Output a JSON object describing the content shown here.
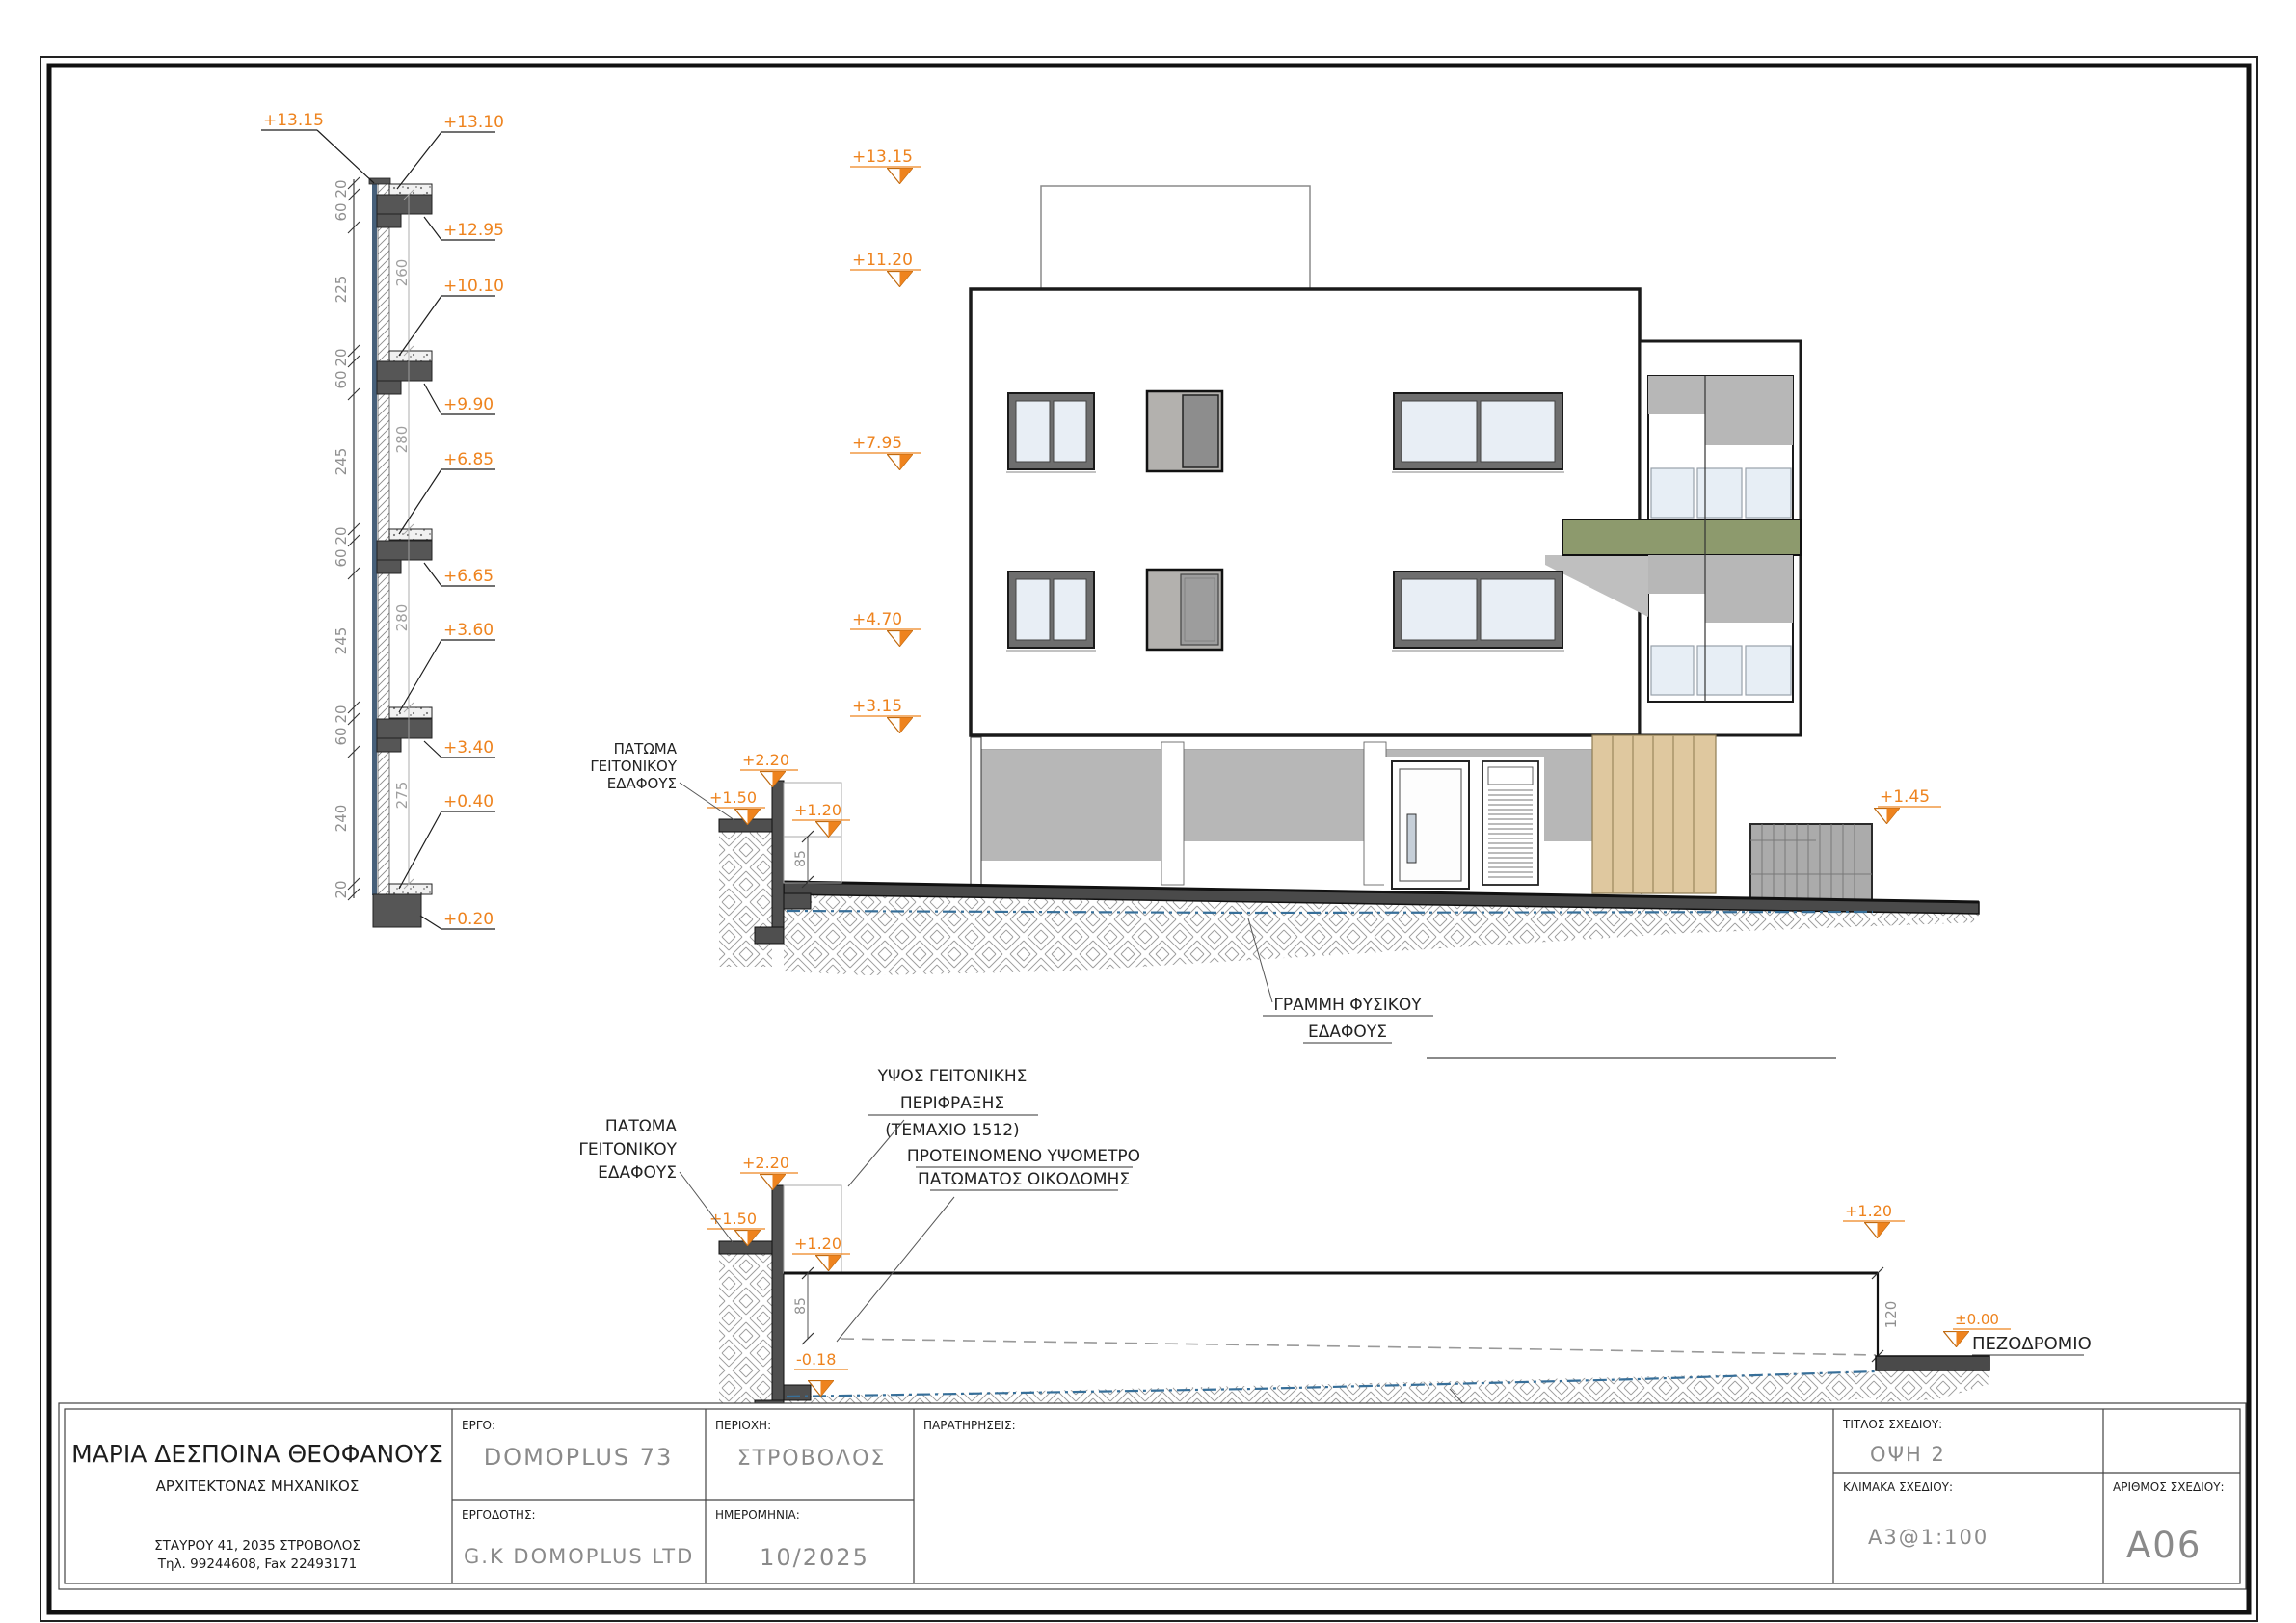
{
  "left_detail": {
    "top_callout": "+13.15",
    "right_callouts": [
      "+13.10",
      "+12.95",
      "+10.10",
      "+9.90",
      "+6.85",
      "+6.65",
      "+3.60",
      "+3.40",
      "+0.40",
      "+0.20"
    ],
    "outer_dims": [
      "20",
      "60",
      "225",
      "20",
      "60",
      "245",
      "20",
      "60",
      "245",
      "20",
      "60",
      "240",
      "20"
    ],
    "inner_dims": [
      "260",
      "280",
      "280",
      "275"
    ]
  },
  "elevation": {
    "markers": [
      "+13.15",
      "+11.20",
      "+7.95",
      "+4.70",
      "+3.15"
    ],
    "fence_marker": "+1.45"
  },
  "section1": {
    "patoma": [
      "ΠΑΤΩΜΑ",
      "ΓΕΙΤΟΝΙΚΟΥ",
      "ΕΔΑΦΟΥΣ"
    ],
    "m220": "+2.20",
    "m150": "+1.50",
    "m120": "+1.20",
    "d85": "85",
    "grammi": [
      "ΓΡΑΜΜΗ ΦΥΣΙΚΟΥ",
      "ΕΔΑΦΟΥΣ"
    ]
  },
  "section2": {
    "patoma": [
      "ΠΑΤΩΜΑ",
      "ΓΕΙΤΟΝΙΚΟΥ",
      "ΕΔΑΦΟΥΣ"
    ],
    "ypsos": [
      "ΥΨΟΣ ΓΕΙΤΟΝΙΚΗΣ",
      "ΠΕΡΙΦΡΑΞΗΣ",
      "(ΤΕΜΑΧΙΟ 1512)"
    ],
    "proteinomeno": [
      "ΠΡΟΤΕΙΝΟΜΕΝΟ ΥΨΟΜΕΤΡΟ",
      "ΠΑΤΩΜΑΤΟΣ ΟΙΚΟΔΟΜΗΣ"
    ],
    "m220": "+2.20",
    "m150": "+1.50",
    "m120": "+1.20",
    "d85": "85",
    "m018": "-0.18",
    "m120r": "+1.20",
    "d120": "120",
    "m000": "±0.00",
    "pezodromio": "ΠΕΖΟΔΡΟΜΙΟ",
    "grammi": [
      "ΓΡΑΜΜΗ ΓΕΙΤΟΝΙΚΟΥ",
      "ΕΔΑΦΟΥΣ"
    ]
  },
  "title_block": {
    "architect_name": "ΜΑΡΙΑ ΔΕΣΠΟΙΝΑ ΘΕΟΦΑΝΟΥΣ",
    "architect_title": "ΑΡΧΙΤΕΚΤΟΝΑΣ ΜΗΧΑΝΙΚΟΣ",
    "architect_address": "ΣΤΑΥΡΟΥ 41, 2035 ΣΤΡΟΒΟΛΟΣ",
    "architect_phone": "Τηλ. 99244608, Fax 22493171",
    "ergo_label": "ΕΡΓΟ:",
    "ergo_value": "DOMOPLUS 73",
    "periochi_label": "ΠΕΡΙΟΧΗ:",
    "periochi_value": "ΣΤΡΟΒΟΛΟΣ",
    "ergodotis_label": "ΕΡΓΟΔΟΤΗΣ:",
    "ergodotis_value": "G.K DOMOPLUS LTD",
    "imerominia_label": "ΗΜΕΡΟΜΗΝΙΑ:",
    "imerominia_value": "10/2025",
    "paratiriseis_label": "ΠΑΡΑΤΗΡΗΣΕΙΣ:",
    "titlos_label": "ΤΙΤΛΟΣ ΣΧΕΔΙΟΥ:",
    "titlos_value": "ΟΨΗ 2",
    "klimaka_label": "ΚΛΙΜΑΚΑ ΣΧΕΔΙΟΥ:",
    "klimaka_value": "A3@1:100",
    "arithmos_label": "ΑΡΙΘΜΟΣ ΣΧΕΔΙΟΥ:",
    "arithmos_value": "A06"
  },
  "colors": {
    "marker_orange": "#ee831e",
    "concrete_dark": "#4a4a4a",
    "wall_gray": "#b7b7b7",
    "olive_slab": "#8d9a6d",
    "timber": "#dfc89f",
    "ground_line_blue": "#376f99"
  }
}
